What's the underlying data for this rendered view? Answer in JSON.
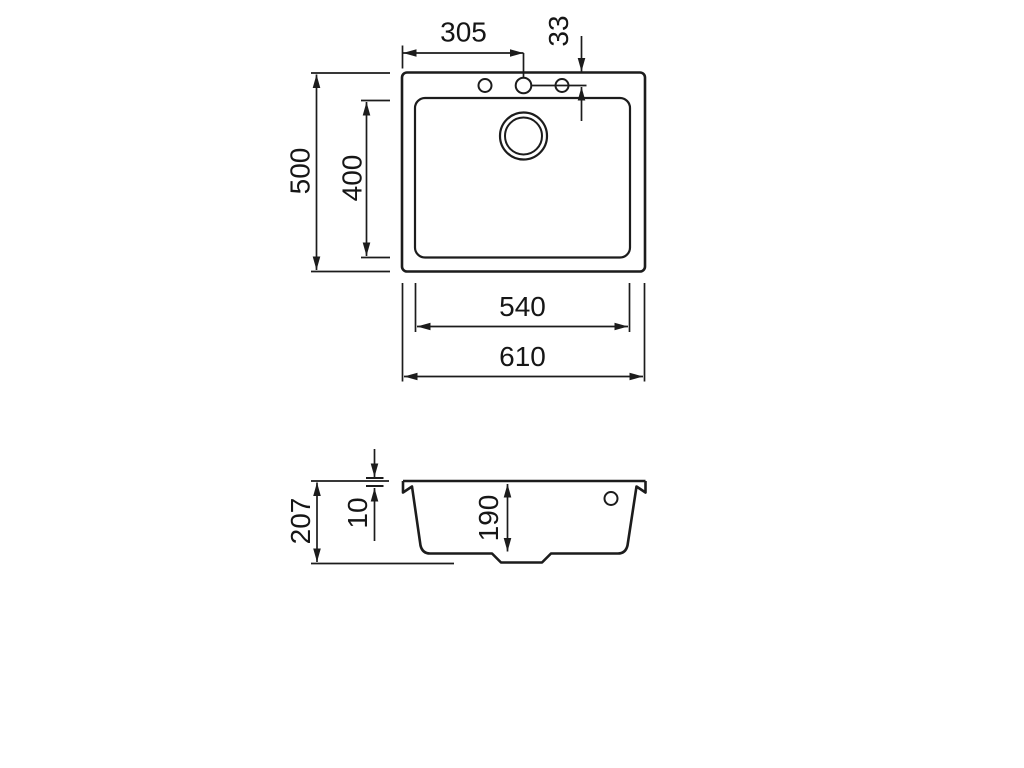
{
  "drawing": {
    "background_color": "#ffffff",
    "line_color": "#1c1c1c",
    "top_view": {
      "dimensions": {
        "tap_hole_offset": "305",
        "tap_hole_edge_distance": "33",
        "overall_depth": "500",
        "bowl_depth": "400",
        "bowl_width": "540",
        "overall_width": "610"
      }
    },
    "section_view": {
      "dimensions": {
        "overall_height": "207",
        "rim_thickness": "10",
        "bowl_inner_depth": "190"
      }
    }
  }
}
